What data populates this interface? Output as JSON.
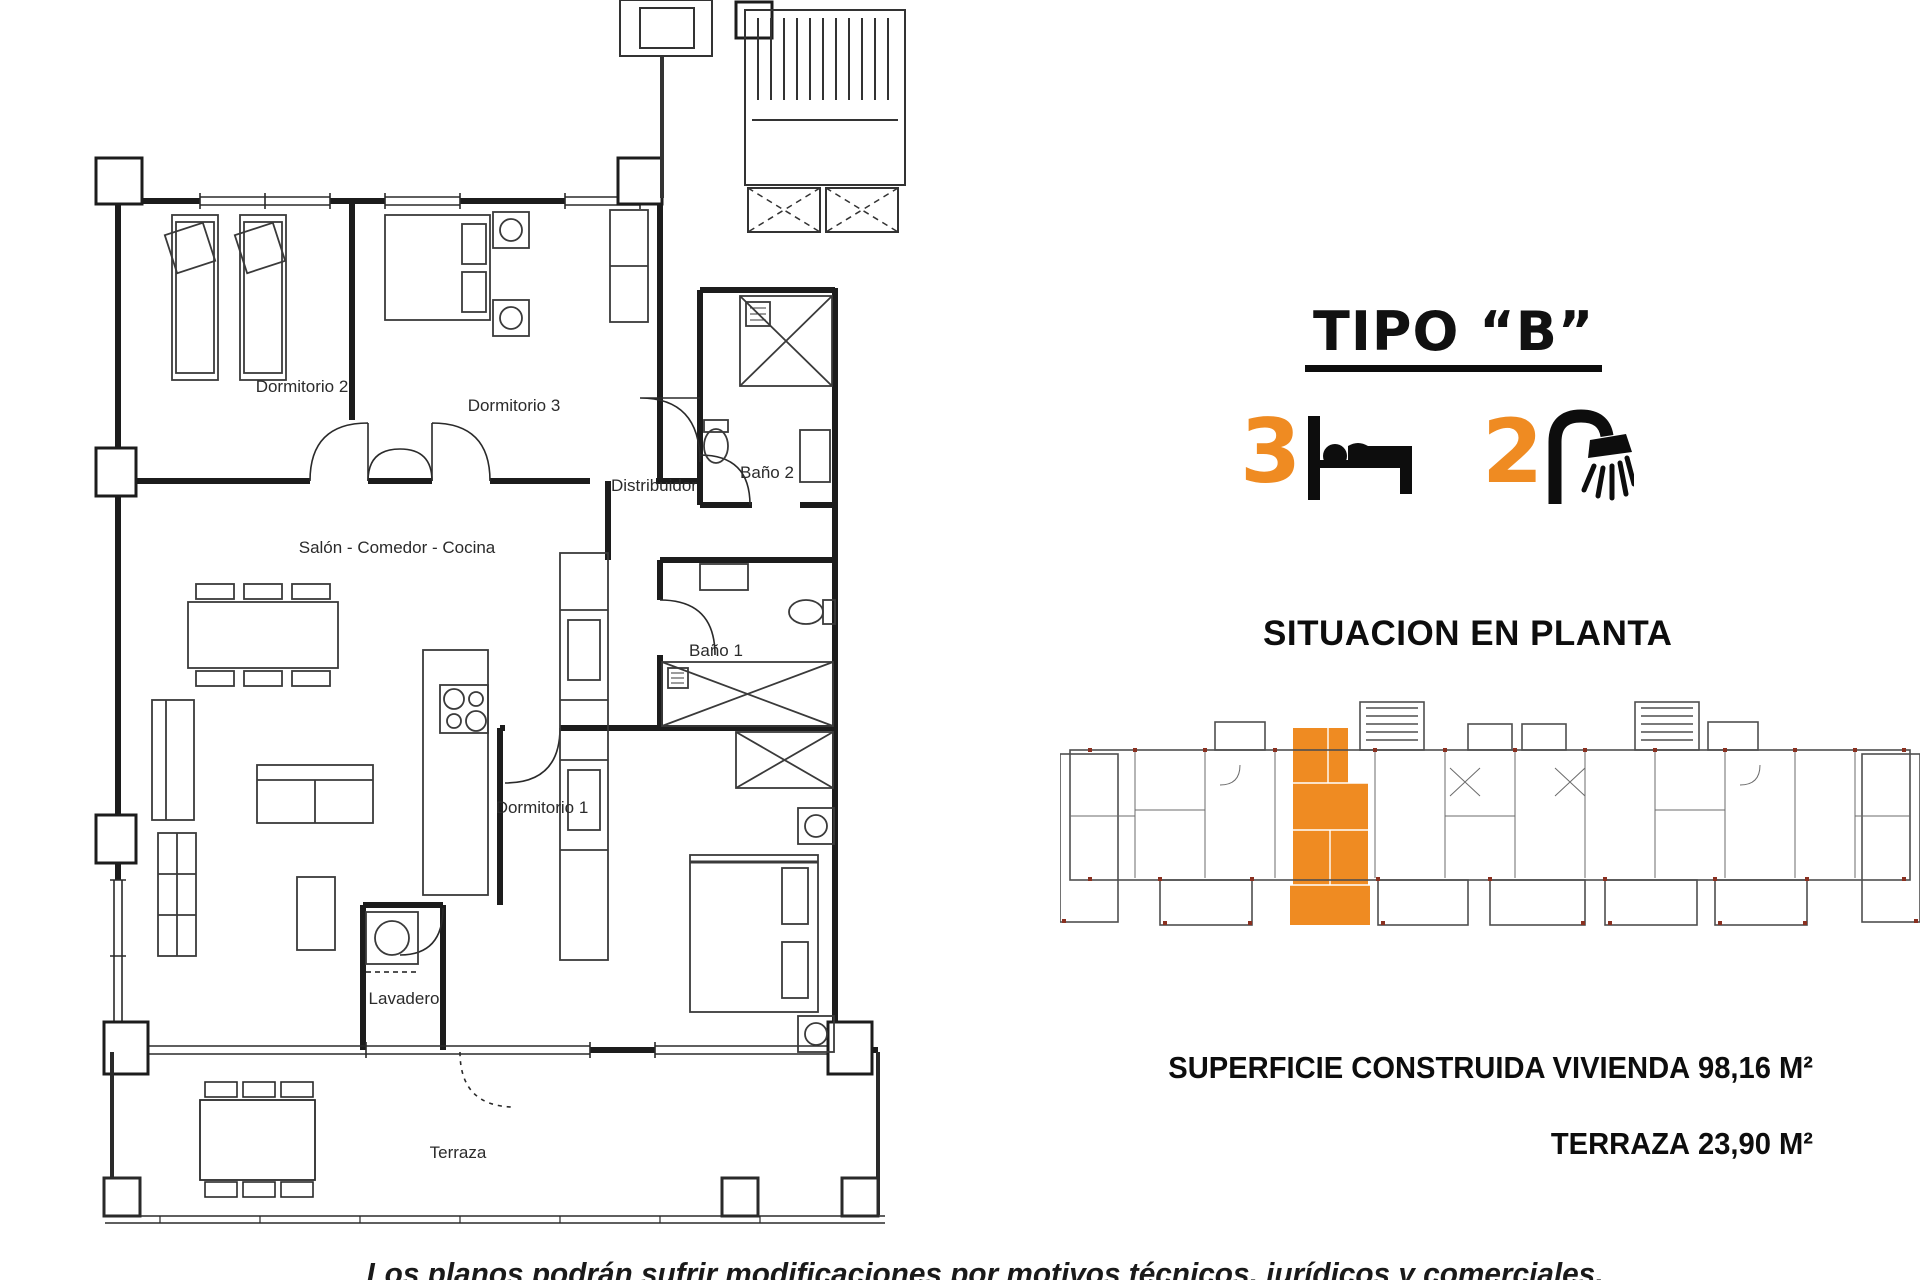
{
  "floor_plan": {
    "rooms": {
      "dormitorio2": "Dormitorio 2",
      "dormitorio3": "Dormitorio 3",
      "bano2": "Baño 2",
      "distribuidor": "Distribuidor",
      "salon": "Salón - Comedor - Cocina",
      "bano1": "Baño 1",
      "dormitorio1": "Dormitorio 1",
      "lavadero": "Lavadero",
      "terraza": "Terraza"
    }
  },
  "details": {
    "title": "TIPO “B”",
    "bedrooms_count": "3",
    "bathrooms_count": "2",
    "icons": {
      "bedrooms": "bed-icon",
      "bathrooms": "shower-icon"
    },
    "section_title": "SITUACION EN PLANTA",
    "areas": [
      {
        "label": "SUPERFICIE CONSTRUIDA VIVIENDA",
        "value": "98,16 M²"
      },
      {
        "label": "TERRAZA",
        "value": "23,90 M²"
      }
    ],
    "accent_color": "#EF8B22"
  },
  "footer": {
    "disclaimer": "Los planos podrán sufrir modificaciones por motivos técnicos, jurídicos y comerciales."
  }
}
